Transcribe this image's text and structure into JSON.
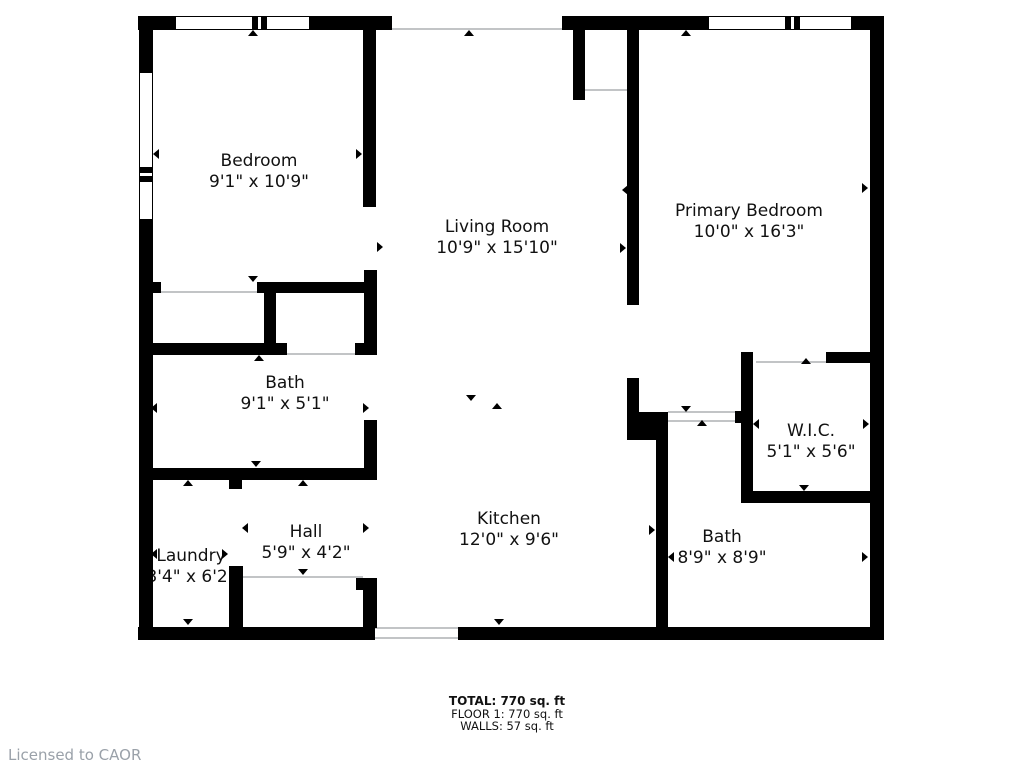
{
  "footer": {
    "total": "TOTAL: 770 sq. ft",
    "floor": "FLOOR 1: 770 sq. ft",
    "walls": "WALLS: 57 sq. ft"
  },
  "watermark": {
    "licensed_to": "Licensed to CAOR"
  },
  "colors": {
    "wall": "#000000",
    "thin_line": "#c2c4c6",
    "watermark_text": "#9aa1a9"
  },
  "rooms": [
    {
      "id": "bedroom",
      "name": "Bedroom",
      "dims": "9'1\" x 10'9\"",
      "cx": 259,
      "cy": 172
    },
    {
      "id": "living-room",
      "name": "Living Room",
      "dims": "10'9\" x 15'10\"",
      "cx": 497,
      "cy": 238
    },
    {
      "id": "primary-bedroom",
      "name": "Primary Bedroom",
      "dims": "10'0\" x 16'3\"",
      "cx": 749,
      "cy": 222
    },
    {
      "id": "bath",
      "name": "Bath",
      "dims": "9'1\" x 5'1\"",
      "cx": 285,
      "cy": 394
    },
    {
      "id": "wic",
      "name": "W.I.C.",
      "dims": "5'1\" x 5'6\"",
      "cx": 811,
      "cy": 442
    },
    {
      "id": "hall",
      "name": "Hall",
      "dims": "5'9\" x 4'2\"",
      "cx": 306,
      "cy": 543
    },
    {
      "id": "laundry",
      "name": "Laundry",
      "dims": "3'4\" x 6'2\"",
      "cx": 191,
      "cy": 567
    },
    {
      "id": "kitchen",
      "name": "Kitchen",
      "dims": "12'0\" x 9'6\"",
      "cx": 509,
      "cy": 530
    },
    {
      "id": "bath-2",
      "name": "Bath",
      "dims": "8'9\" x 8'9\"",
      "cx": 722,
      "cy": 548
    }
  ],
  "floorplan": {
    "walls": [
      {
        "x": 138,
        "y": 16,
        "w": 37,
        "h": 14
      },
      {
        "x": 310,
        "y": 16,
        "w": 82,
        "h": 14
      },
      {
        "x": 562,
        "y": 16,
        "w": 146,
        "h": 14
      },
      {
        "x": 852,
        "y": 16,
        "w": 32,
        "h": 14
      },
      {
        "x": 139,
        "y": 16,
        "w": 14,
        "h": 56
      },
      {
        "x": 139,
        "y": 220,
        "w": 14,
        "h": 420
      },
      {
        "x": 870,
        "y": 16,
        "w": 14,
        "h": 624
      },
      {
        "x": 138,
        "y": 627,
        "w": 237,
        "h": 13
      },
      {
        "x": 458,
        "y": 627,
        "w": 426,
        "h": 13
      },
      {
        "x": 363,
        "y": 30,
        "w": 13,
        "h": 177
      },
      {
        "x": 364,
        "y": 270,
        "w": 13,
        "h": 85
      },
      {
        "x": 257,
        "y": 282,
        "w": 120,
        "h": 11
      },
      {
        "x": 264,
        "y": 282,
        "w": 12,
        "h": 68
      },
      {
        "x": 153,
        "y": 282,
        "w": 8,
        "h": 11
      },
      {
        "x": 152,
        "y": 343,
        "w": 135,
        "h": 12
      },
      {
        "x": 355,
        "y": 343,
        "w": 10,
        "h": 12
      },
      {
        "x": 139,
        "y": 468,
        "w": 238,
        "h": 12
      },
      {
        "x": 364,
        "y": 420,
        "w": 13,
        "h": 60
      },
      {
        "x": 229,
        "y": 480,
        "w": 13,
        "h": 9
      },
      {
        "x": 229,
        "y": 566,
        "w": 14,
        "h": 62
      },
      {
        "x": 356,
        "y": 578,
        "w": 21,
        "h": 12
      },
      {
        "x": 363,
        "y": 590,
        "w": 14,
        "h": 38
      },
      {
        "x": 627,
        "y": 16,
        "w": 12,
        "h": 289
      },
      {
        "x": 627,
        "y": 378,
        "w": 12,
        "h": 34
      },
      {
        "x": 627,
        "y": 412,
        "w": 41,
        "h": 28
      },
      {
        "x": 656,
        "y": 440,
        "w": 12,
        "h": 188
      },
      {
        "x": 573,
        "y": 16,
        "w": 12,
        "h": 84
      },
      {
        "x": 741,
        "y": 352,
        "w": 12,
        "h": 151
      },
      {
        "x": 826,
        "y": 352,
        "w": 44,
        "h": 11
      },
      {
        "x": 741,
        "y": 491,
        "w": 129,
        "h": 12
      },
      {
        "x": 735,
        "y": 411,
        "w": 7,
        "h": 12
      }
    ],
    "thin_lines": [
      {
        "x": 585,
        "y": 89,
        "w": 42,
        "h": 2
      },
      {
        "x": 243,
        "y": 576,
        "w": 120,
        "h": 2
      },
      {
        "x": 668,
        "y": 411,
        "w": 73,
        "h": 2
      },
      {
        "x": 668,
        "y": 420,
        "w": 73,
        "h": 2
      },
      {
        "x": 161,
        "y": 291,
        "w": 96,
        "h": 2
      },
      {
        "x": 287,
        "y": 353,
        "w": 68,
        "h": 2
      },
      {
        "x": 392,
        "y": 28,
        "w": 170,
        "h": 2
      },
      {
        "x": 375,
        "y": 627,
        "w": 83,
        "h": 2
      },
      {
        "x": 375,
        "y": 637,
        "w": 83,
        "h": 2
      },
      {
        "x": 756,
        "y": 361,
        "w": 70,
        "h": 2
      }
    ],
    "windows": [
      {
        "x": 175,
        "y": 16,
        "w": 135,
        "h": 14,
        "orient": "h",
        "mullions": [
          76,
          85
        ]
      },
      {
        "x": 708,
        "y": 16,
        "w": 144,
        "h": 14,
        "orient": "h",
        "mullions": [
          76,
          85
        ]
      },
      {
        "x": 139,
        "y": 72,
        "w": 14,
        "h": 148,
        "orient": "v",
        "mullions": [
          94,
          103
        ]
      }
    ],
    "markers": [
      {
        "x": 253,
        "y": 33,
        "dir": "up"
      },
      {
        "x": 469,
        "y": 33,
        "dir": "up"
      },
      {
        "x": 686,
        "y": 33,
        "dir": "up"
      },
      {
        "x": 156,
        "y": 154,
        "dir": "left"
      },
      {
        "x": 359,
        "y": 154,
        "dir": "right"
      },
      {
        "x": 380,
        "y": 247,
        "dir": "right"
      },
      {
        "x": 623,
        "y": 248,
        "dir": "right"
      },
      {
        "x": 625,
        "y": 190,
        "dir": "left"
      },
      {
        "x": 865,
        "y": 188,
        "dir": "right"
      },
      {
        "x": 253,
        "y": 279,
        "dir": "down"
      },
      {
        "x": 259,
        "y": 358,
        "dir": "up"
      },
      {
        "x": 154,
        "y": 408,
        "dir": "left"
      },
      {
        "x": 366,
        "y": 408,
        "dir": "right"
      },
      {
        "x": 471,
        "y": 398,
        "dir": "down"
      },
      {
        "x": 497,
        "y": 406,
        "dir": "up"
      },
      {
        "x": 686,
        "y": 409,
        "dir": "down"
      },
      {
        "x": 702,
        "y": 423,
        "dir": "up"
      },
      {
        "x": 756,
        "y": 424,
        "dir": "left"
      },
      {
        "x": 866,
        "y": 424,
        "dir": "right"
      },
      {
        "x": 806,
        "y": 361,
        "dir": "up"
      },
      {
        "x": 804,
        "y": 488,
        "dir": "down"
      },
      {
        "x": 652,
        "y": 530,
        "dir": "right"
      },
      {
        "x": 671,
        "y": 557,
        "dir": "left"
      },
      {
        "x": 865,
        "y": 557,
        "dir": "right"
      },
      {
        "x": 154,
        "y": 554,
        "dir": "left"
      },
      {
        "x": 225,
        "y": 554,
        "dir": "right"
      },
      {
        "x": 245,
        "y": 528,
        "dir": "left"
      },
      {
        "x": 366,
        "y": 528,
        "dir": "right"
      },
      {
        "x": 303,
        "y": 572,
        "dir": "down"
      },
      {
        "x": 256,
        "y": 464,
        "dir": "down"
      },
      {
        "x": 188,
        "y": 483,
        "dir": "up"
      },
      {
        "x": 303,
        "y": 483,
        "dir": "up"
      },
      {
        "x": 188,
        "y": 622,
        "dir": "down"
      },
      {
        "x": 499,
        "y": 622,
        "dir": "down"
      }
    ]
  }
}
